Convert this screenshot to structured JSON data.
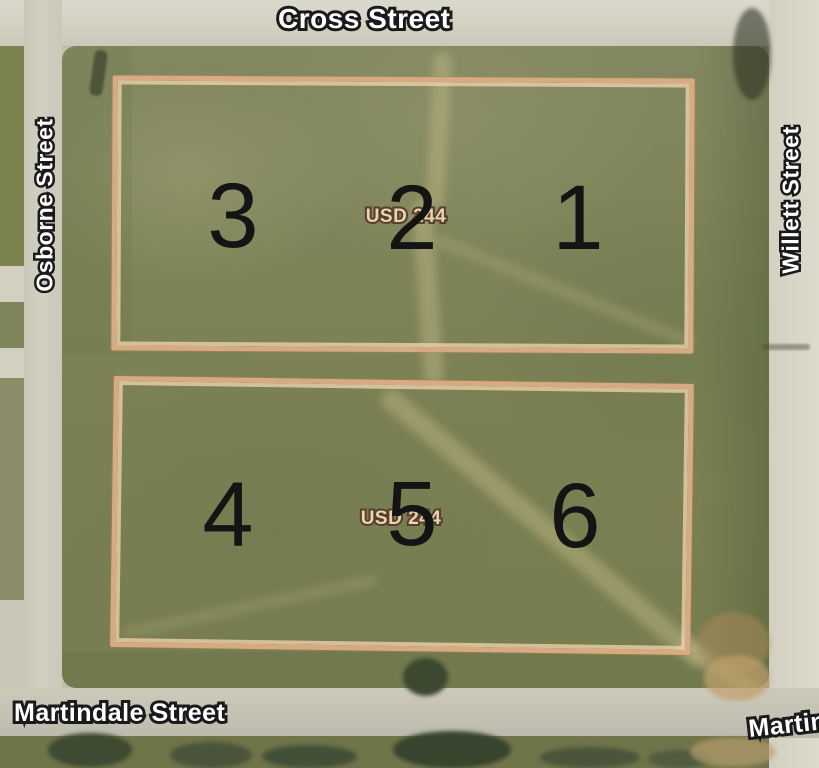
{
  "map": {
    "streets": {
      "top": "Cross Street",
      "left": "Osborne Street",
      "right": "Willett Street",
      "bottom": "Martindale Street",
      "bottom_right": "Martindale Street"
    },
    "lots": [
      {
        "number": "3"
      },
      {
        "number": "2"
      },
      {
        "number": "1"
      },
      {
        "number": "4"
      },
      {
        "number": "5"
      },
      {
        "number": "6"
      }
    ],
    "district_labels": {
      "upper": "USD 244",
      "lower": "USD 244"
    },
    "colors": {
      "lot_outline": "#d7ab81",
      "lot_outline_highlight": "#ebd1aa",
      "district_text": "#ecd3ad",
      "street_text": "#ffffff",
      "street_text_outline": "#1a1a1a",
      "field_green": "#7e8457",
      "road_gray": "#d2cfc1",
      "lot_number_text": "#141414"
    }
  }
}
